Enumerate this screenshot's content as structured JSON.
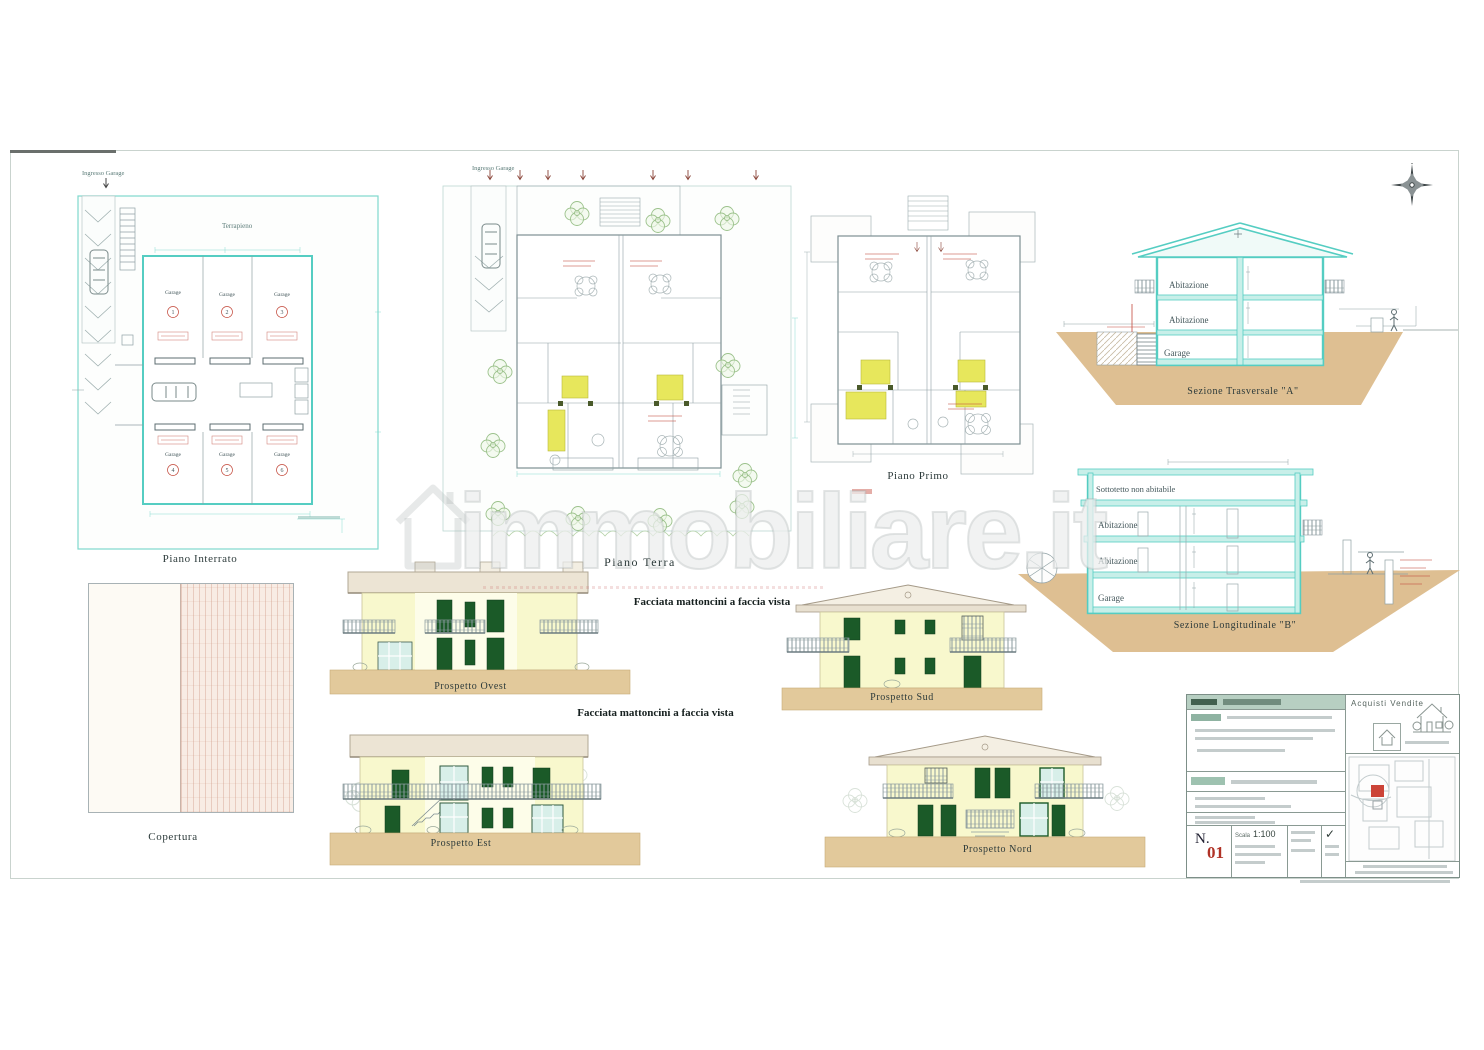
{
  "watermark": {
    "text": "immobiliare.it"
  },
  "annotations": {
    "ingresso_garage": "Ingresso Garage",
    "terrapieno": "Terrapieno",
    "garage": "Garage",
    "facade_note": "Facciata mattoncini a faccia vista"
  },
  "plans": {
    "interrato": {
      "title": "Piano Interrato",
      "units": [
        "1",
        "2",
        "3",
        "4",
        "5",
        "6"
      ]
    },
    "terra": {
      "title": "Piano Terra"
    },
    "primo": {
      "title": "Piano Primo"
    }
  },
  "sections": {
    "trasversale": {
      "title": "Sezione Trasversale \"A\"",
      "floors": [
        "Abitazione",
        "Abitazione",
        "Garage"
      ]
    },
    "longitudinale": {
      "title": "Sezione Longitudinale \"B\"",
      "floors": [
        "Sottotetto non abitabile",
        "Abitazione",
        "Abitazione",
        "Garage"
      ]
    }
  },
  "elevations": {
    "ovest": {
      "title": "Prospetto Ovest"
    },
    "sud": {
      "title": "Prospetto Sud"
    },
    "est": {
      "title": "Prospetto Est"
    },
    "nord": {
      "title": "Prospetto Nord"
    }
  },
  "roof_plan": {
    "title": "Copertura"
  },
  "title_block": {
    "sheet_label": "N.",
    "sheet_number": "01",
    "scale_label": "Scala",
    "scale_value": "1:100",
    "agency_text": "Acquisti  Vendite"
  },
  "colors": {
    "wall_teal": "#55cdc2",
    "ground_tan": "#debf92",
    "facade_yellow": "#f8f8cd",
    "window_green": "#1b5a28",
    "annotation_red": "#c34a3c",
    "tree_green": "#9cc28c"
  }
}
